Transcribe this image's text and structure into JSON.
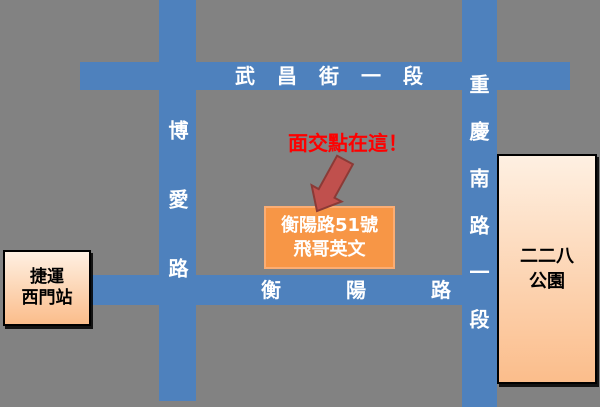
{
  "map": {
    "title": "面交地圖",
    "background_color": "#828282",
    "road_color": "#4E81BD"
  },
  "roads": {
    "wuchang": {
      "label": "武昌街一段",
      "orientation": "horizontal"
    },
    "hengyang": {
      "label": "衡陽路",
      "orientation": "horizontal"
    },
    "boai": {
      "label": "博愛路",
      "orientation": "vertical"
    },
    "chongqing": {
      "label": "重慶南路一段",
      "orientation": "vertical"
    }
  },
  "annotation": {
    "text": "面交點在這！",
    "color": "#FE0000",
    "arrow_fill": "#C0504D",
    "arrow_stroke": "#8B3A36"
  },
  "destination": {
    "line1": "衡陽路51號",
    "line2": "飛哥英文",
    "fill": "#F79646",
    "text_color": "#FFFFFF"
  },
  "station": {
    "line1": "捷運",
    "line2": "西門站",
    "fill_top": "#FEF0E2",
    "fill_bottom": "#FBBD8B"
  },
  "park": {
    "line1": "二二八",
    "line2": "公園",
    "fill_top": "#FEF0E2",
    "fill_bottom": "#FBBD8B"
  }
}
